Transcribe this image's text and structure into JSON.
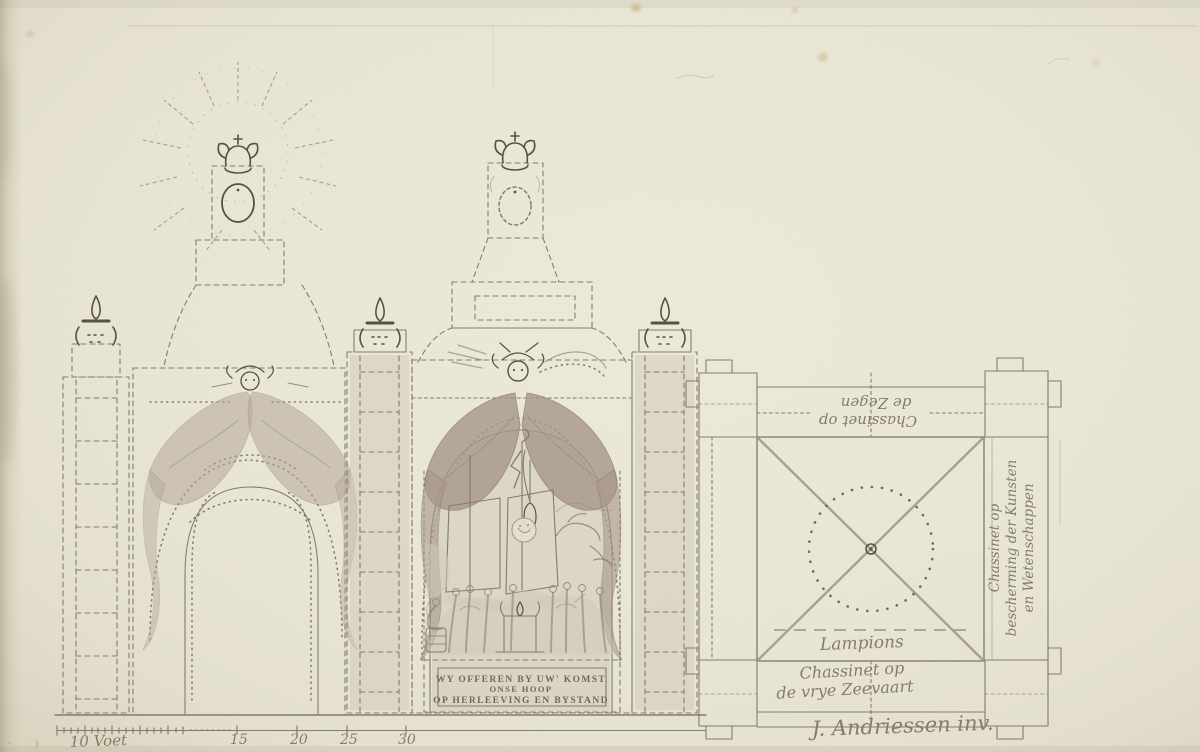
{
  "banner": {
    "line1": "WY OFFEREN BY UW' KOMST",
    "line2": "ONSE HOOP",
    "line3": "OP HERLEEVING EN BYSTAND"
  },
  "plan": {
    "top_label": {
      "line1": "Chassinet op",
      "line2": "de Zegen"
    },
    "right_label": {
      "line1": "Chassinet op",
      "line2": "bescherming der Kunsten",
      "line3": "en Wetenschappen"
    },
    "lampions": "Lampions",
    "bottom_label": {
      "line1": "Chassinet op",
      "line2": "de vrye Zeevaart"
    }
  },
  "scale": {
    "labels": [
      "10 Voet",
      "15",
      "20",
      "25",
      "30"
    ]
  },
  "signature": "J. Andriessen inv.",
  "colors": {
    "paper": "#eae6d6",
    "ink": "#7d7767",
    "graphite": "#9a9482",
    "wash_drapery": "#a79889",
    "wash_light": "#cfc9b6",
    "dark_ink": "#57523f"
  }
}
